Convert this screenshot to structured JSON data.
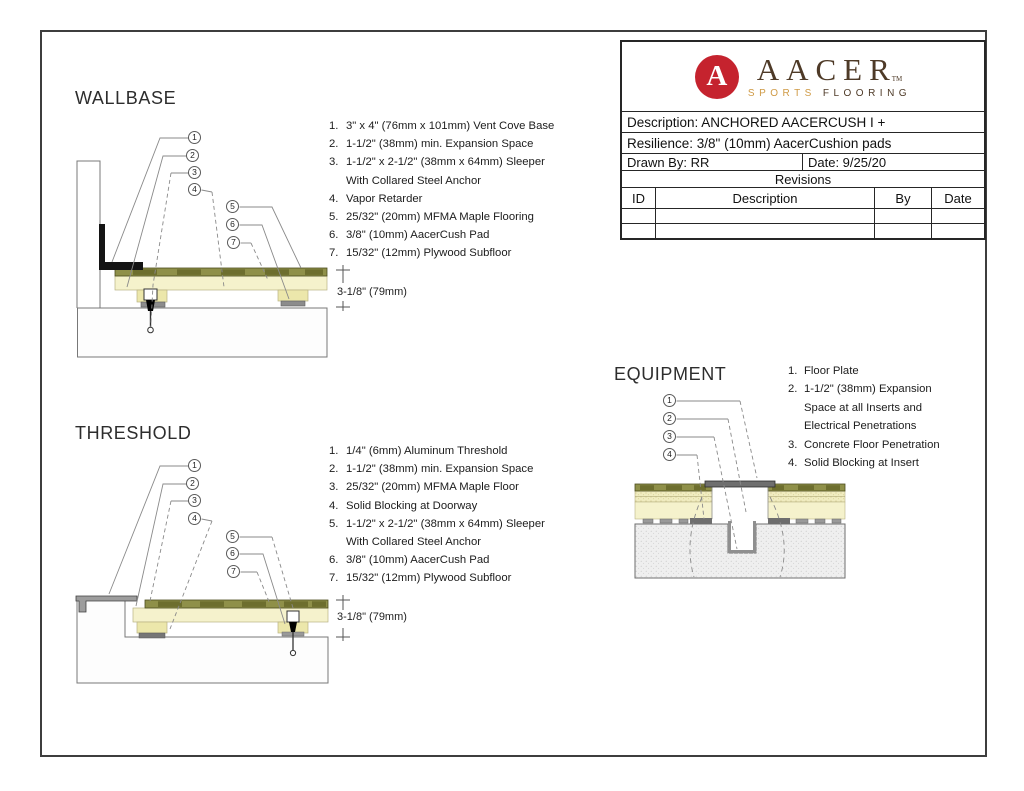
{
  "logo": {
    "monogram": "A",
    "brand": "AACER",
    "tm": "TM",
    "tagline_sports": "SPORTS",
    "tagline_flooring": "FLOORING",
    "red": "#c5232e",
    "brown": "#4e3a27",
    "gold": "#cf9a45"
  },
  "titleblock": {
    "description": "Description: ANCHORED AACERCUSH I +",
    "resilience": "Resilience: 3/8\" (10mm) AacerCushion pads",
    "drawn_by": "Drawn By: RR",
    "date": "Date: 9/25/20",
    "revisions_label": "Revisions",
    "columns": [
      "ID",
      "Description",
      "By",
      "Date"
    ]
  },
  "wallbase": {
    "title": "WALLBASE",
    "dimension": "3-1/8\" (79mm)",
    "callouts": [
      "1",
      "2",
      "3",
      "4",
      "5",
      "6",
      "7"
    ],
    "notes": [
      {
        "num": "1.",
        "text": "3\" x 4\" (76mm x 101mm) Vent Cove Base"
      },
      {
        "num": "2.",
        "text": "1-1/2\" (38mm) min. Expansion Space"
      },
      {
        "num": "3.",
        "text": "1-1/2\" x 2-1/2\" (38mm x 64mm) Sleeper"
      },
      {
        "num": "",
        "text": "With Collared Steel Anchor"
      },
      {
        "num": "4.",
        "text": "Vapor Retarder"
      },
      {
        "num": "5.",
        "text": "25/32\" (20mm) MFMA Maple Flooring"
      },
      {
        "num": "6.",
        "text": "3/8\" (10mm) AacerCush Pad"
      },
      {
        "num": "7.",
        "text": "15/32\" (12mm) Plywood Subfloor"
      }
    ]
  },
  "threshold": {
    "title": "THRESHOLD",
    "dimension": "3-1/8\" (79mm)",
    "callouts": [
      "1",
      "2",
      "3",
      "4",
      "5",
      "6",
      "7"
    ],
    "notes": [
      {
        "num": "1.",
        "text": "1/4\" (6mm) Aluminum Threshold"
      },
      {
        "num": "2.",
        "text": "1-1/2\" (38mm) min. Expansion Space"
      },
      {
        "num": "3.",
        "text": "25/32\" (20mm) MFMA Maple Floor"
      },
      {
        "num": "4.",
        "text": "Solid Blocking at Doorway"
      },
      {
        "num": "5.",
        "text": "1-1/2\" x 2-1/2\" (38mm x 64mm) Sleeper"
      },
      {
        "num": "",
        "text": "With Collared Steel Anchor"
      },
      {
        "num": "6.",
        "text": "3/8\" (10mm) AacerCush Pad"
      },
      {
        "num": "7.",
        "text": "15/32\" (12mm) Plywood Subfloor"
      }
    ]
  },
  "equipment": {
    "title": "EQUIPMENT",
    "callouts": [
      "1",
      "2",
      "3",
      "4"
    ],
    "notes": [
      {
        "num": "1.",
        "text": "Floor Plate"
      },
      {
        "num": "2.",
        "text": "1-1/2\" (38mm) Expansion"
      },
      {
        "num": "",
        "text": "Space at all Inserts and"
      },
      {
        "num": "",
        "text": "Electrical Penetrations"
      },
      {
        "num": "3.",
        "text": "Concrete Floor Penetration"
      },
      {
        "num": "4.",
        "text": "Solid Blocking at Insert"
      }
    ]
  }
}
